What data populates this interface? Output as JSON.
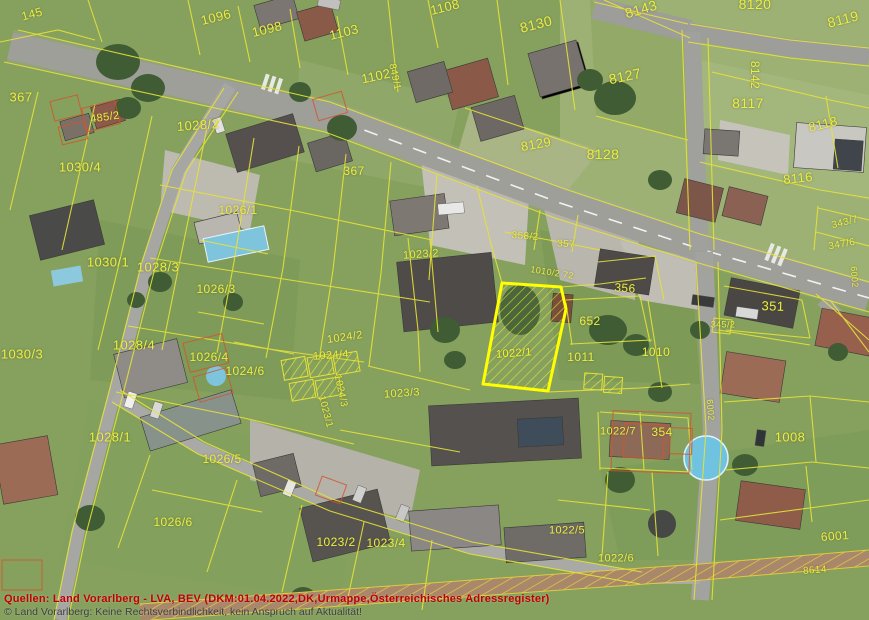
{
  "map": {
    "type": "aerial-cadastral-map",
    "region": "Vorarlberg residential area with cadastral parcel overlay",
    "colors": {
      "parcel_line": "#e6e338",
      "highlight_outline": "#ffff00",
      "label_text": "#eded42",
      "urmappe_overlay": "#d4542c",
      "footer_red": "#c00000",
      "footer_gray": "#3f3f3f"
    },
    "highlight_parcel": {
      "label": "1022/1",
      "style": "yellow outline with diagonal hatch"
    },
    "labels": [
      {
        "t": "145",
        "x": 32,
        "y": 14,
        "r": -15,
        "s": 12
      },
      {
        "t": "1096",
        "x": 216,
        "y": 17,
        "r": -14,
        "s": 13
      },
      {
        "t": "1098",
        "x": 267,
        "y": 29,
        "r": -14,
        "s": 13
      },
      {
        "t": "1103",
        "x": 344,
        "y": 32,
        "r": -14,
        "s": 13
      },
      {
        "t": "1108",
        "x": 445,
        "y": 7,
        "r": -14,
        "s": 13
      },
      {
        "t": "8130",
        "x": 536,
        "y": 24,
        "r": -14,
        "s": 14
      },
      {
        "t": "8143",
        "x": 641,
        "y": 9,
        "r": -16,
        "s": 14
      },
      {
        "t": "8120",
        "x": 755,
        "y": 4,
        "r": 0,
        "s": 14
      },
      {
        "t": "8119",
        "x": 843,
        "y": 19,
        "r": -14,
        "s": 14
      },
      {
        "t": "8142",
        "x": 755,
        "y": 75,
        "r": 90,
        "s": 12
      },
      {
        "t": "8127",
        "x": 625,
        "y": 76,
        "r": -12,
        "s": 14
      },
      {
        "t": "367",
        "x": 21,
        "y": 97,
        "r": 0,
        "s": 13
      },
      {
        "t": "485/2",
        "x": 105,
        "y": 118,
        "r": -8,
        "s": 11
      },
      {
        "t": "1028/2",
        "x": 198,
        "y": 125,
        "r": -4,
        "s": 13
      },
      {
        "t": "1102",
        "x": 376,
        "y": 76,
        "r": -12,
        "s": 13
      },
      {
        "t": "849/1",
        "x": 394,
        "y": 77,
        "r": 78,
        "s": 10
      },
      {
        "t": "8129",
        "x": 536,
        "y": 144,
        "r": -10,
        "s": 13
      },
      {
        "t": "8128",
        "x": 603,
        "y": 154,
        "r": 0,
        "s": 14
      },
      {
        "t": "8117",
        "x": 748,
        "y": 103,
        "r": 0,
        "s": 14
      },
      {
        "t": "8118",
        "x": 823,
        "y": 124,
        "r": -14,
        "s": 13
      },
      {
        "t": "8116",
        "x": 798,
        "y": 178,
        "r": -6,
        "s": 13
      },
      {
        "t": "343/7",
        "x": 845,
        "y": 223,
        "r": -14,
        "s": 10
      },
      {
        "t": "347/6",
        "x": 842,
        "y": 245,
        "r": -10,
        "s": 10
      },
      {
        "t": "1030/4",
        "x": 80,
        "y": 167,
        "r": 0,
        "s": 13
      },
      {
        "t": "367",
        "x": 354,
        "y": 171,
        "r": 0,
        "s": 12
      },
      {
        "t": "1030/1",
        "x": 108,
        "y": 262,
        "r": 0,
        "s": 13
      },
      {
        "t": "1028/3",
        "x": 158,
        "y": 267,
        "r": 0,
        "s": 13
      },
      {
        "t": "1026/1",
        "x": 238,
        "y": 210,
        "r": 0,
        "s": 12
      },
      {
        "t": "1026/3",
        "x": 216,
        "y": 289,
        "r": 0,
        "s": 12
      },
      {
        "t": "1023/2",
        "x": 421,
        "y": 255,
        "r": -4,
        "s": 11
      },
      {
        "t": "358/2",
        "x": 525,
        "y": 237,
        "r": 4,
        "s": 10
      },
      {
        "t": "357",
        "x": 566,
        "y": 245,
        "r": 4,
        "s": 10
      },
      {
        "t": "1010/2 72",
        "x": 552,
        "y": 273,
        "r": 9,
        "s": 9
      },
      {
        "t": "356",
        "x": 625,
        "y": 288,
        "r": 4,
        "s": 12
      },
      {
        "t": "652",
        "x": 590,
        "y": 321,
        "r": 0,
        "s": 12
      },
      {
        "t": "351",
        "x": 773,
        "y": 306,
        "r": 2,
        "s": 13
      },
      {
        "t": "6002",
        "x": 854,
        "y": 277,
        "r": 85,
        "s": 9
      },
      {
        "t": "345/2",
        "x": 723,
        "y": 325,
        "r": 0,
        "s": 9
      },
      {
        "t": "1030/3",
        "x": 22,
        "y": 354,
        "r": 0,
        "s": 13
      },
      {
        "t": "1028/4",
        "x": 134,
        "y": 345,
        "r": 0,
        "s": 13
      },
      {
        "t": "1026/4",
        "x": 209,
        "y": 357,
        "r": 0,
        "s": 12
      },
      {
        "t": "1024/6",
        "x": 245,
        "y": 371,
        "r": 0,
        "s": 12
      },
      {
        "t": "1024/2",
        "x": 345,
        "y": 338,
        "r": -8,
        "s": 11
      },
      {
        "t": "1024/4",
        "x": 331,
        "y": 356,
        "r": -4,
        "s": 11
      },
      {
        "t": "1024/3",
        "x": 340,
        "y": 391,
        "r": 78,
        "s": 10
      },
      {
        "t": "1022/1",
        "x": 514,
        "y": 354,
        "r": -4,
        "s": 11,
        "hl": true
      },
      {
        "t": "1011",
        "x": 581,
        "y": 357,
        "r": 0,
        "s": 12
      },
      {
        "t": "1010",
        "x": 656,
        "y": 352,
        "r": 0,
        "s": 12
      },
      {
        "t": "1023/3",
        "x": 402,
        "y": 394,
        "r": -4,
        "s": 11
      },
      {
        "t": "1023/1",
        "x": 325,
        "y": 412,
        "r": 75,
        "s": 10
      },
      {
        "t": "1028/1",
        "x": 110,
        "y": 437,
        "r": 0,
        "s": 13
      },
      {
        "t": "1026/5",
        "x": 222,
        "y": 459,
        "r": 0,
        "s": 12
      },
      {
        "t": "1026/6",
        "x": 173,
        "y": 522,
        "r": 0,
        "s": 12
      },
      {
        "t": "1023/2",
        "x": 336,
        "y": 542,
        "r": 0,
        "s": 12
      },
      {
        "t": "1023/4",
        "x": 386,
        "y": 543,
        "r": 0,
        "s": 12
      },
      {
        "t": "1022/5",
        "x": 567,
        "y": 531,
        "r": 0,
        "s": 11
      },
      {
        "t": "1022/7",
        "x": 618,
        "y": 432,
        "r": 0,
        "s": 11
      },
      {
        "t": "354",
        "x": 662,
        "y": 432,
        "r": 0,
        "s": 12
      },
      {
        "t": "1008",
        "x": 790,
        "y": 437,
        "r": 0,
        "s": 13
      },
      {
        "t": "6002",
        "x": 710,
        "y": 410,
        "r": 85,
        "s": 9
      },
      {
        "t": "6001",
        "x": 835,
        "y": 536,
        "r": -4,
        "s": 12
      },
      {
        "t": "1022/6",
        "x": 616,
        "y": 559,
        "r": 0,
        "s": 11
      },
      {
        "t": "8614",
        "x": 815,
        "y": 571,
        "r": -4,
        "s": 10
      }
    ]
  },
  "footer": {
    "line1": "Quellen: Land Vorarlberg - LVA, BEV (DKM:01.04.2022,DK,Urmappe,Österreichisches Adressregister)",
    "line2": "© Land Vorarlberg: Keine Rechtsverbindlichkeit, kein Anspruch auf Aktualität!"
  }
}
